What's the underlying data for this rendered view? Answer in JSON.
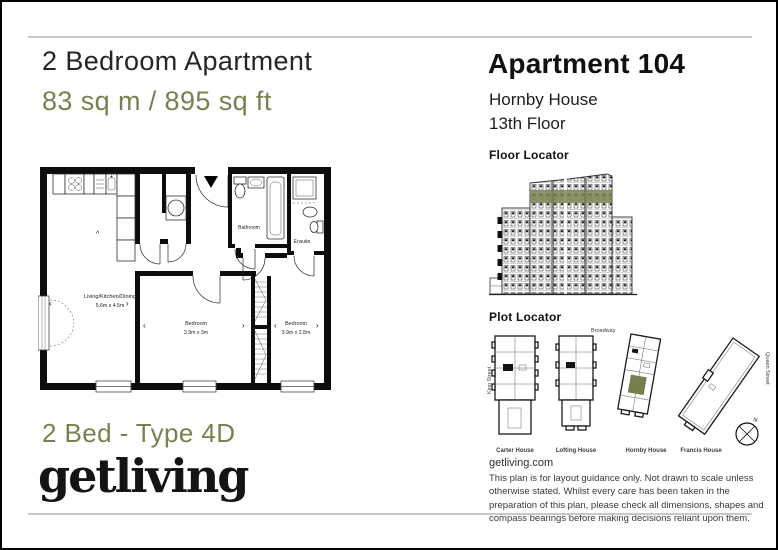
{
  "header": {
    "title": "2 Bedroom Apartment",
    "area": "83 sq m / 895 sq ft"
  },
  "apartment": {
    "name": "Apartment 104",
    "building": "Hornby House",
    "floor": "13th Floor"
  },
  "floor_locator": {
    "title": "Floor Locator"
  },
  "plot_locator": {
    "title": "Plot Locator",
    "streets": {
      "top": "Broadway",
      "left": "King Street",
      "right": "Queen Street"
    },
    "plots": [
      {
        "name": "Carter House",
        "highlighted": false
      },
      {
        "name": "Lofting House",
        "highlighted": false
      },
      {
        "name": "Hornby House",
        "highlighted": true
      },
      {
        "name": "Francis House",
        "highlighted": false
      }
    ],
    "compass": "N"
  },
  "floorplan": {
    "rooms": [
      {
        "name": "Living/Kitchen/Dining",
        "dims": "5.6m x 4.5m"
      },
      {
        "name": "Bathroom",
        "dims": ""
      },
      {
        "name": "Ensuite",
        "dims": ""
      },
      {
        "name": "Bedroom",
        "dims": "3.9m x 3m"
      },
      {
        "name": "Bedroom",
        "dims": "3.9m x 2.8m"
      }
    ],
    "glyphs": {
      "left": "‹",
      "right": "›",
      "up": "^"
    }
  },
  "footer": {
    "type_label": "2 Bed - Type 4D",
    "logo": "getliving",
    "website": "getliving.com",
    "disclaimer": "This plan is for layout guidance only. Not drawn to scale unless otherwise stated. Whilst every care has been taken in the preparation of this plan, please check all dimensions, shapes and compass bearings before making decisions reliant upon them."
  },
  "colors": {
    "accent": "#78814f",
    "ink": "#1f1f1f"
  }
}
